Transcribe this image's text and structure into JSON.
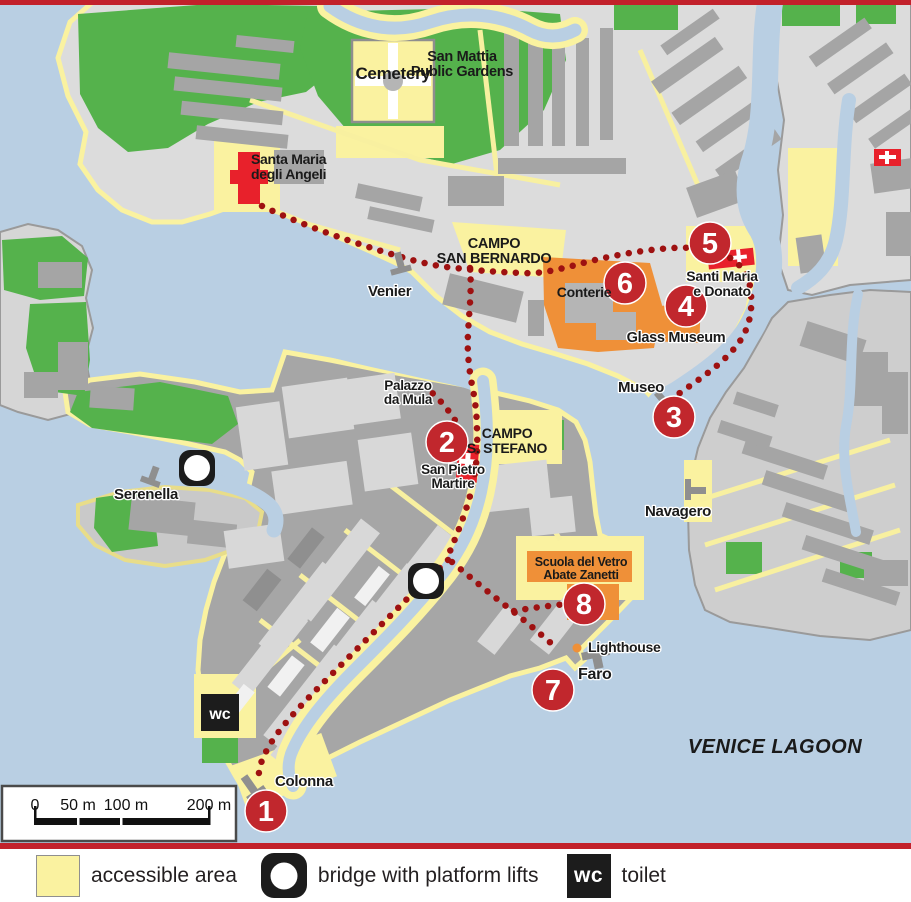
{
  "colors": {
    "water": "#b9cfe3",
    "accessible_yellow": "#faf2a0",
    "park_green": "#55b24c",
    "land_light": "#dcdcdc",
    "land_mid": "#a6a6a6",
    "building_dark": "#a5a5a5",
    "building_light": "#d8d8d8",
    "orange_highlight": "#ef9038",
    "route_red": "#9e1111",
    "marker_red": "#c1272d",
    "church_red": "#e8212b",
    "divider_red": "#c2212b"
  },
  "map": {
    "region_label": "VENICE LAGOON",
    "wc_label": "wc",
    "labels": [
      {
        "id": "cemetery",
        "x": 393,
        "y": 79,
        "size": 17,
        "anchor": "middle",
        "lh": 17,
        "lines": [
          "Cemetery"
        ]
      },
      {
        "id": "san-mattia-gardens",
        "x": 462,
        "y": 61,
        "size": 14.5,
        "anchor": "middle",
        "lh": 15,
        "lines": [
          "San Mattia",
          "Public Gardens"
        ]
      },
      {
        "id": "santa-maria-degli-angeli",
        "x": 251,
        "y": 164,
        "size": 14,
        "anchor": "start",
        "lh": 15,
        "lines": [
          "Santa Maria",
          "degli Angeli"
        ]
      },
      {
        "id": "campo-san-bernardo",
        "x": 494,
        "y": 248,
        "size": 14.5,
        "anchor": "middle",
        "lh": 15,
        "lines": [
          "CAMPO",
          "SAN BERNARDO"
        ]
      },
      {
        "id": "venier",
        "x": 368,
        "y": 296,
        "size": 15,
        "anchor": "start",
        "lh": 15,
        "halo": true,
        "lines": [
          "Venier"
        ]
      },
      {
        "id": "conterie",
        "x": 584,
        "y": 297,
        "size": 14,
        "anchor": "middle",
        "lh": 14,
        "lines": [
          "Conterie"
        ]
      },
      {
        "id": "santi-maria-e-donato",
        "x": 722,
        "y": 281,
        "size": 14,
        "anchor": "middle",
        "lh": 15,
        "halo": true,
        "lines": [
          "Santi Maria",
          "e Donato"
        ]
      },
      {
        "id": "glass-museum",
        "x": 676,
        "y": 342,
        "size": 14.5,
        "anchor": "middle",
        "lh": 15,
        "halo": true,
        "lines": [
          "Glass Museum"
        ]
      },
      {
        "id": "museo",
        "x": 641,
        "y": 392,
        "size": 15,
        "anchor": "middle",
        "lh": 15,
        "halo": true,
        "lines": [
          "Museo"
        ]
      },
      {
        "id": "palazzo-da-mula",
        "x": 408,
        "y": 390,
        "size": 13.5,
        "anchor": "middle",
        "lh": 14,
        "halo": true,
        "lines": [
          "Palazzo",
          "da Mula"
        ]
      },
      {
        "id": "campo-s-stefano",
        "x": 507,
        "y": 438,
        "size": 14,
        "anchor": "middle",
        "lh": 15,
        "lines": [
          "CAMPO",
          "S. STEFANO"
        ]
      },
      {
        "id": "san-pietro-martire",
        "x": 453,
        "y": 474,
        "size": 13.5,
        "anchor": "middle",
        "lh": 14,
        "halo": true,
        "lines": [
          "San Pietro",
          "Martire"
        ]
      },
      {
        "id": "serenella",
        "x": 146,
        "y": 499,
        "size": 15,
        "anchor": "middle",
        "lh": 15,
        "halo": true,
        "lines": [
          "Serenella"
        ]
      },
      {
        "id": "navagero",
        "x": 678,
        "y": 516,
        "size": 15,
        "anchor": "middle",
        "lh": 15,
        "halo": true,
        "lines": [
          "Navagero"
        ]
      },
      {
        "id": "scuola-del-vetro",
        "x": 581,
        "y": 566,
        "size": 12.5,
        "anchor": "middle",
        "lh": 13,
        "lines": [
          "Scuola del Vetro",
          "Abate Zanetti"
        ]
      },
      {
        "id": "lighthouse",
        "x": 588,
        "y": 652,
        "size": 14,
        "anchor": "start",
        "lh": 14,
        "halo": true,
        "lines": [
          "Lighthouse"
        ]
      },
      {
        "id": "faro",
        "x": 578,
        "y": 679,
        "size": 16,
        "anchor": "start",
        "lh": 16,
        "halo": true,
        "lines": [
          "Faro"
        ]
      },
      {
        "id": "colonna",
        "x": 275,
        "y": 786,
        "size": 15,
        "anchor": "start",
        "lh": 15,
        "halo": true,
        "lines": [
          "Colonna"
        ]
      }
    ],
    "stops": [
      {
        "number": "1",
        "x": 266,
        "y": 811
      },
      {
        "number": "2",
        "x": 447,
        "y": 442
      },
      {
        "number": "3",
        "x": 674,
        "y": 417
      },
      {
        "number": "4",
        "x": 686,
        "y": 306
      },
      {
        "number": "5",
        "x": 710,
        "y": 243
      },
      {
        "number": "6",
        "x": 625,
        "y": 283
      },
      {
        "number": "7",
        "x": 553,
        "y": 690
      },
      {
        "number": "8",
        "x": 584,
        "y": 604
      }
    ]
  },
  "scalebar": {
    "labels": [
      "0",
      "50 m",
      "100 m",
      "200 m"
    ]
  },
  "legend": {
    "items": [
      {
        "id": "accessible-area",
        "label": "accessible area"
      },
      {
        "id": "bridge-platform-lifts",
        "label": "bridge with platform lifts"
      },
      {
        "id": "toilet",
        "label": "toilet",
        "icon_text": "wc"
      }
    ]
  }
}
